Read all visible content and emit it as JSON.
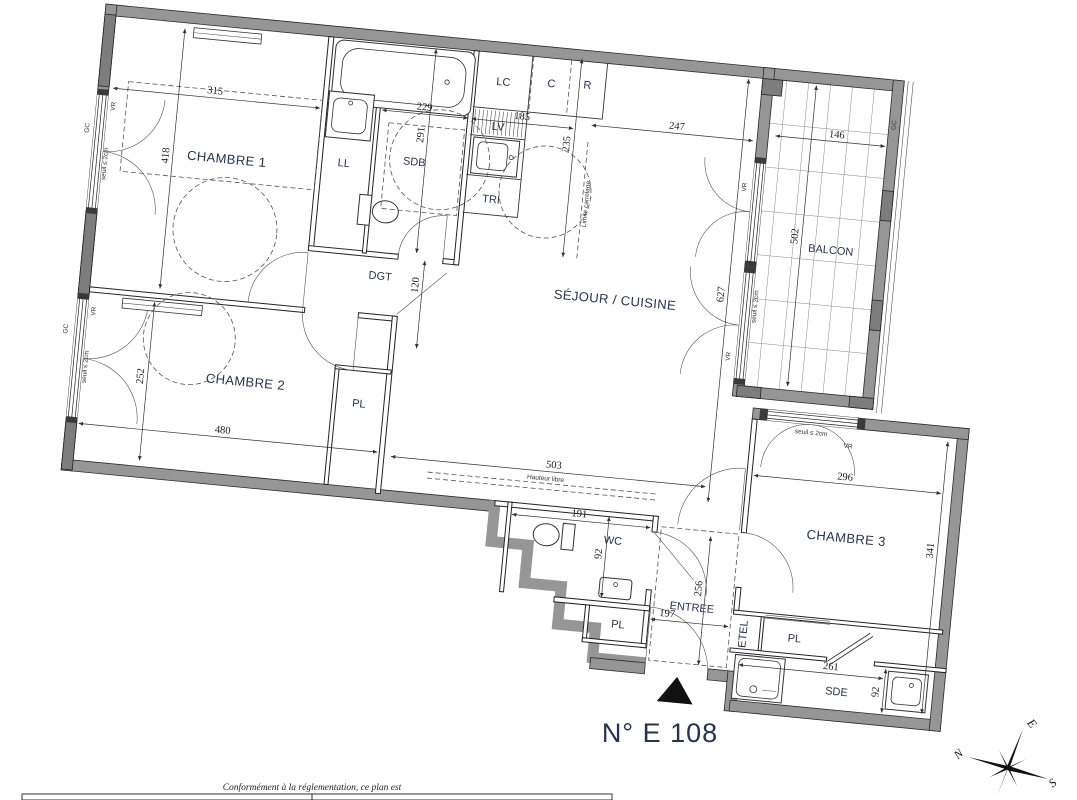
{
  "title": "N° E 108",
  "footer": {
    "note": "Conformément à la réglementation, ce plan est"
  },
  "compass": {
    "n": "N",
    "e": "E",
    "s": "S"
  },
  "rooms": {
    "chambre1": "CHAMBRE 1",
    "chambre2": "CHAMBRE 2",
    "chambre3": "CHAMBRE 3",
    "sejour": "SÉJOUR / CUISINE",
    "balcon": "BALCON",
    "sdb": "SDB",
    "sde": "SDE",
    "wc": "WC",
    "entree": "ENTREE",
    "dgt": "DGT",
    "ll": "LL",
    "lv": "LV",
    "lc": "LC",
    "c": "C",
    "r": "R",
    "tri": "TRI",
    "pl": "PL",
    "etel": "ETEL"
  },
  "dims": {
    "chambre1_w": "315",
    "chambre1_h": "418",
    "sdb_w": "229",
    "sdb_h": "291",
    "kitchen_w": "185",
    "kitchen_h": "235",
    "sejour_top": "247",
    "sejour_h": "627",
    "sejour_w": "503",
    "balcon_w": "146",
    "balcon_h": "502",
    "dgt_w": "120",
    "chambre2_w": "480",
    "chambre2_h": "252",
    "wc_w": "191",
    "wc_h": "92",
    "entree_w": "197",
    "entree_h": "256",
    "chambre3_w": "296",
    "chambre3_h": "341",
    "sde_w": "261",
    "sde_h": "92"
  },
  "annotations": {
    "gc": "GC",
    "vr": "VR",
    "seuil": "seuil ≤ 2cm",
    "limite_carrelage": "Limite carrelage",
    "hauteur_libre": "Hauteur libre"
  }
}
